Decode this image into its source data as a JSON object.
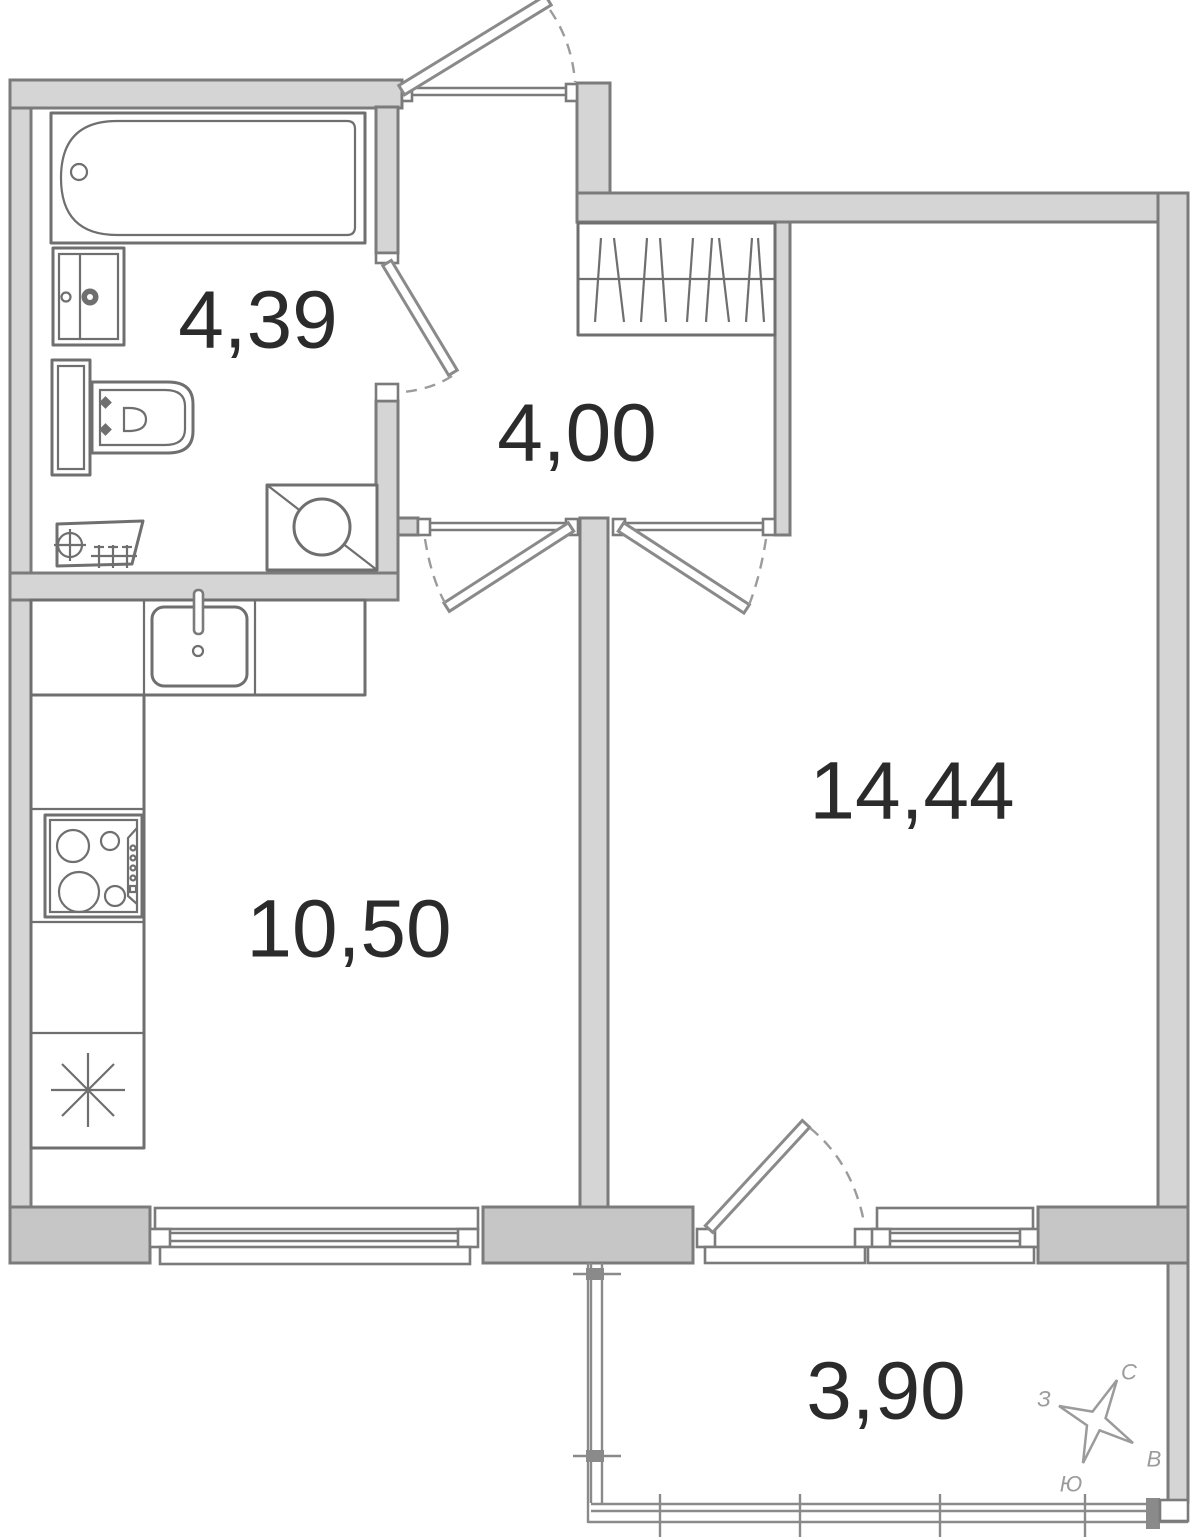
{
  "plan": {
    "rooms": [
      {
        "id": "bathroom",
        "area": "4,39"
      },
      {
        "id": "hallway",
        "area": "4,00"
      },
      {
        "id": "kitchen",
        "area": "10,50"
      },
      {
        "id": "living-room",
        "area": "14,44"
      },
      {
        "id": "balcony",
        "area": "3,90"
      }
    ]
  },
  "compass": {
    "north": "С",
    "west": "З",
    "east": "В",
    "south": "Ю"
  },
  "colors": {
    "wall_fill": "#d5d5d5",
    "wall_fill_dark": "#c6c6c6",
    "wall_outline": "#7b7b7b",
    "fixture_line": "#6f6f6f",
    "label_text": "#2b2b2b",
    "compass_gray": "#9b9b9b"
  }
}
